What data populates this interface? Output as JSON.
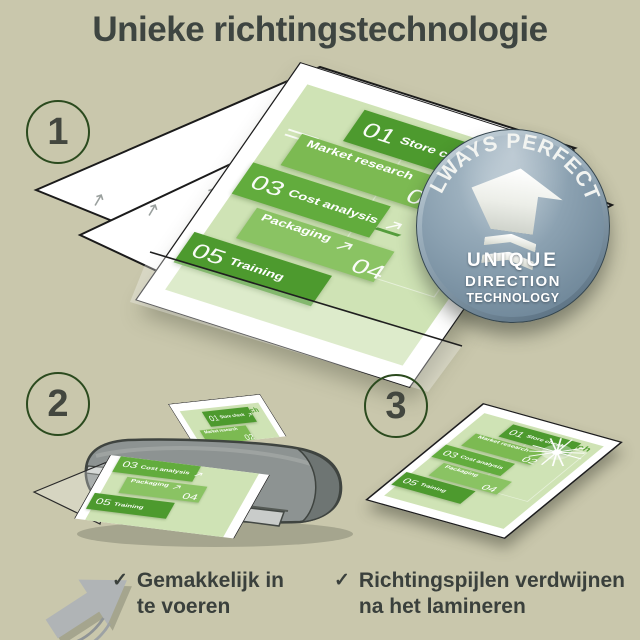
{
  "title": "Unieke richtingstechnologie",
  "steps": [
    {
      "number": "1"
    },
    {
      "number": "2"
    },
    {
      "number": "3"
    }
  ],
  "badge": {
    "arc_text": "ALWAYS PERFECT!",
    "lines": [
      "UNIQUE",
      "DIRECTION",
      "TECHNOLOGY"
    ]
  },
  "document": {
    "launch_label": "Launch",
    "tiles": [
      {
        "num": "01",
        "label": "Store check",
        "num_side": "left",
        "color": "#4d9a2e",
        "arrow": true
      },
      {
        "num": "02",
        "label": "Market research",
        "num_side": "right",
        "color": "#7cba52",
        "arrow": false
      },
      {
        "num": "03",
        "label": "Cost analysis",
        "num_side": "left",
        "color": "#62ac3d",
        "arrow": true
      },
      {
        "num": "04",
        "label": "Packaging",
        "num_side": "right",
        "color": "#8ac363",
        "arrow": true
      },
      {
        "num": "05",
        "label": "Training",
        "num_side": "left",
        "color": "#4d9a2e",
        "arrow": false
      }
    ]
  },
  "checklist": {
    "check_icon": "✓",
    "items": [
      {
        "line1": "Gemakkelijk in",
        "line2": "te voeren"
      },
      {
        "line1": "Richtingspijlen verdwijnen",
        "line2": "na het lamineren"
      }
    ]
  },
  "colors": {
    "background": "#c9c7ac",
    "title_text": "#3e4541",
    "circle_outline": "#2b4a1e",
    "page_green": "#cfe3b5",
    "launch_green": "#4f9e2f",
    "tile_dark_green": "#4d9a2e",
    "tile_light_green": "#8ac363",
    "badge_face": "#7e95a6",
    "laminator_gray": "#8d9392",
    "arrow_gray": "#b0b4b6",
    "text_dark": "#3a403c"
  }
}
